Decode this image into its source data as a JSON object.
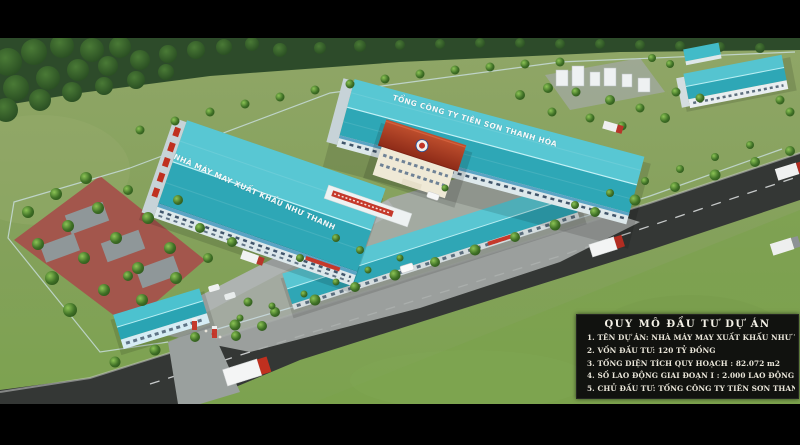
{
  "buildings": {
    "left_factory_roof_text": "NHÀ MÁY MAY XUẤT KHẨU NHƯ THANH",
    "top_factory_roof_text": "TỔNG CÔNG TY TIÊN SƠN THANH HÓA"
  },
  "info_box": {
    "title": "QUY MÔ ĐẦU TƯ DỰ ÁN",
    "lines": [
      "1. TÊN DỰ ÁN:  NHÀ MÁY MAY XUẤT KHẨU NHƯ THANH",
      "2. VỐN ĐẦU TƯ: 120 TỶ ĐỒNG",
      "3. TỔNG DIỆN TÍCH QUY HOẠCH : 82.072 m2",
      "4. SỐ LAO ĐỘNG GIAI ĐOẠN I : 2.000 LAO ĐỘNG",
      "5. CHỦ ĐẦU TƯ:  TỔNG CÔNG TY TIÊN SƠN THANH HÓA"
    ]
  },
  "colors": {
    "roof_teal_light": "#58c7d3",
    "roof_teal_dark": "#2ea7b6",
    "office_roof_red": "#a8381f",
    "asphalt": "#35383634",
    "grass": "#8aa263",
    "forest": "#2d4b2a",
    "paving_red": "#a3564c",
    "info_box_bg": "#0c0c0c",
    "info_box_text": "#eae6da",
    "banner_red": "#c5392b"
  }
}
